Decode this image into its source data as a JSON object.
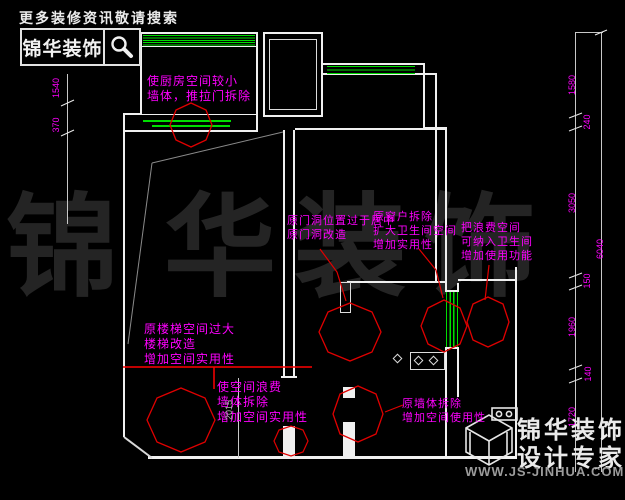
{
  "header": {
    "search_hint": "更多装修资讯敬请搜索",
    "logo_text": "锦华装饰"
  },
  "watermark": {
    "chars": [
      "锦",
      "华",
      "装",
      "饰"
    ]
  },
  "annotations": {
    "kitchen_wall": "使厨房空间较小\n墙体，推拉门拆除",
    "door_centered": "原门洞位置过于居中\n原门洞改造",
    "window_removed": "原窗户拆除\n扩大卫生间空间\n增加实用性",
    "wasted_space": "把浪费空间\n可纳入卫生间\n增加使用功能",
    "stair_space": "原楼梯空间过大\n楼梯改造\n增加空间实用性",
    "wall_removed_left": "使空间浪费\n墙体拆除\n增加空间实用性",
    "wall_removed_right": "原墙体拆除\n增加空间使用性"
  },
  "dimensions": {
    "left": [
      "1540",
      "370"
    ],
    "top_left": "240",
    "right": [
      "1580",
      "240",
      "3050",
      "150",
      "1960",
      "140",
      "1720"
    ],
    "right_total": "6040",
    "bottom": "2015"
  },
  "footer": {
    "brand_line1": "锦华装饰",
    "brand_line2": "设计专家",
    "url": "WWW.JS-JINHUA.COM"
  },
  "icons": {
    "header_icon": "magnifier-icon",
    "footer_icon": "wireframe-cube-icon"
  },
  "colors": {
    "background": "#000000",
    "wall": "#f0f0f0",
    "window_hatch": "#00dd00",
    "annotation_text": "#ff00ff",
    "revision_cloud": "#e00000",
    "watermark": "#242424",
    "stair_outline": "#8a8a8a"
  }
}
